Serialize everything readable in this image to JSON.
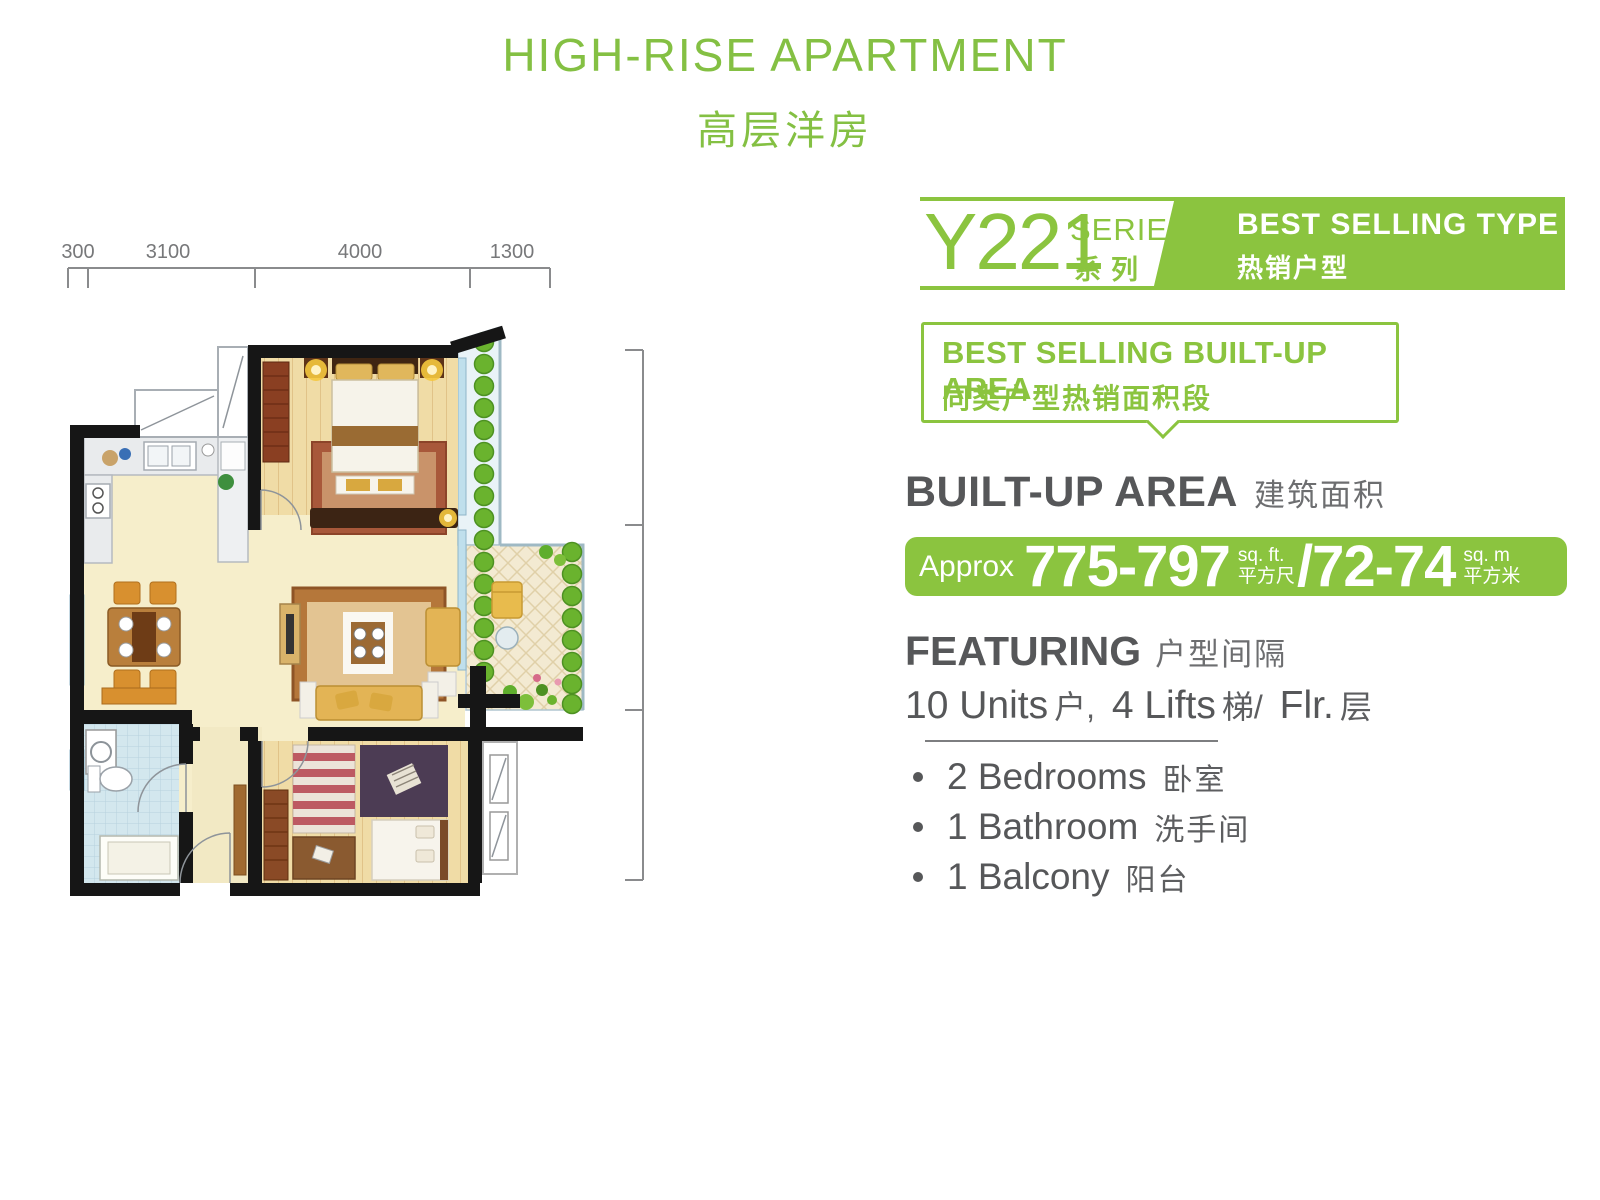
{
  "title": {
    "en": "HIGH-RISE APARTMENT",
    "zh": "高层洋房"
  },
  "series": {
    "code": "Y221",
    "label_en": "SERIES",
    "label_zh": "系列",
    "badge_en": "BEST SELLING TYPE",
    "badge_zh": "热销户型"
  },
  "callout": {
    "line1": "BEST SELLING BUILT-UP AREA",
    "line2": "同类户型热销面积段"
  },
  "area": {
    "heading_en": "BUILT-UP AREA",
    "heading_zh": "建筑面积",
    "approx": "Approx",
    "sqft": "775-797",
    "sqft_unit_en": "sq. ft.",
    "sqft_unit_zh": "平方尺",
    "slash": "/",
    "sqm": "72-74",
    "sqm_unit_en": "sq. m",
    "sqm_unit_zh": "平方米"
  },
  "featuring": {
    "heading_en": "FEATURING",
    "heading_zh": "户型间隔",
    "p1": "10 Units",
    "p2": "户,",
    "p3": "4 Lifts",
    "p4": "梯/",
    "p5": "Flr.",
    "p6": "层"
  },
  "features": [
    {
      "en": "2 Bedrooms",
      "zh": "卧室"
    },
    {
      "en": "1 Bathroom",
      "zh": "洗手间"
    },
    {
      "en": "1 Balcony",
      "zh": "阳台"
    }
  ],
  "floor_plan": {
    "dims_top": [
      "300",
      "3100",
      "4000",
      "1300"
    ],
    "dims_right": [
      "3400",
      "3600",
      "3000"
    ]
  },
  "colors": {
    "green": "#8BC43F",
    "text_dark": "#58585A",
    "text_gray": "#6D6E70",
    "dim_gray": "#77787A",
    "wall_black": "#161616"
  }
}
